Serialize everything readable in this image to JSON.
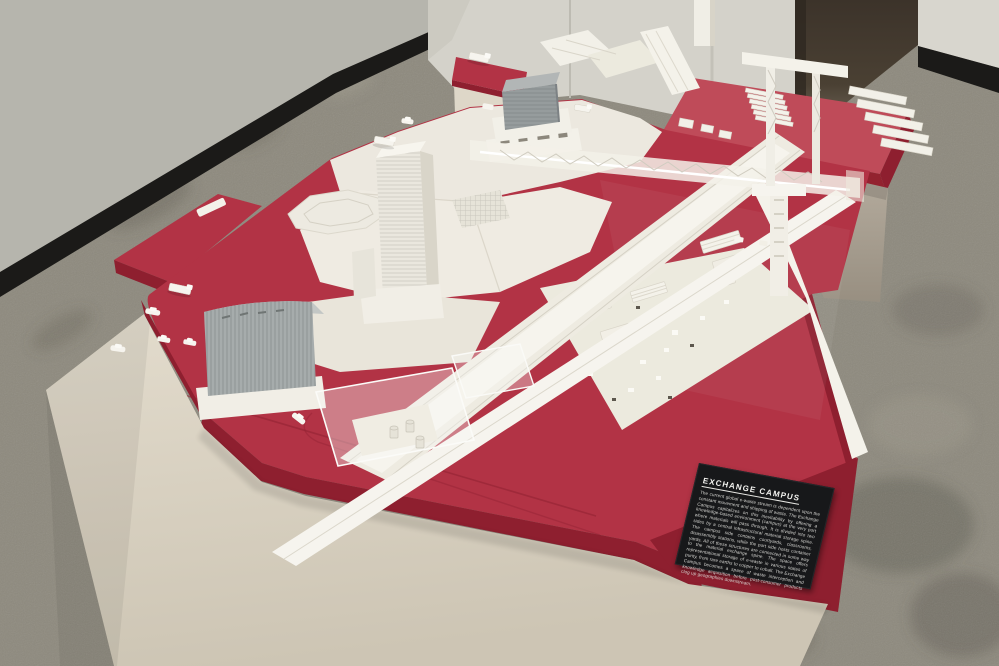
{
  "scene": {
    "description": "Gallery photograph: large red-and-white architectural scale model of an e-waste port campus displayed on white pedestals, concrete floor, white gallery walls with black baseboards and a dark doorway at top right.",
    "exhibit_name": "EXCHANGE CAMPUS"
  },
  "plaque": {
    "title": "EXCHANGE CAMPUS",
    "body": "The current global e-waste stream is dependent upon the constant movement and shipping of waste. The Exchange Campus capitalizes on this inevitability by offering a knowledge-based environment (campus) at the very port where materials will pass through. It is divided into two sides by a central infrastructural material storage spine. The campus side contains courtyards, classrooms, disassembly stations, while the port side hosts container yards. All of these structures are connected in some way to the material exchange spine. The space offers representational storage of e-waste in various states of purity, from rare earths to copper to cobalt. The Exchange Campus becomes a space of waste interception and knowledge acquisition before post-consumer products clog up geographies downstream."
  },
  "colors": {
    "floor": "#8e8a7e",
    "floor_stain": "#5f5a4e",
    "wall_left": "#b6b5ad",
    "pedestal_wall": "#d4d2ca",
    "doorway": "#42382b",
    "wall_right": "#d8d6ce",
    "baseboard": "#1b1a18",
    "red_top": "#b23345",
    "red_top_light": "#bf4b59",
    "red_side": "#8e1f2f",
    "pedestal": "#ddd5c6",
    "gray_pedestal": "#b0a799",
    "model_white": "#efece3",
    "model_bright": "#f7f5ee",
    "model_shadow": "#d9d5c9",
    "building_gray": "#969c9d",
    "plaque_bg": "#17181a",
    "plaque_text": "#e9e9e6"
  }
}
